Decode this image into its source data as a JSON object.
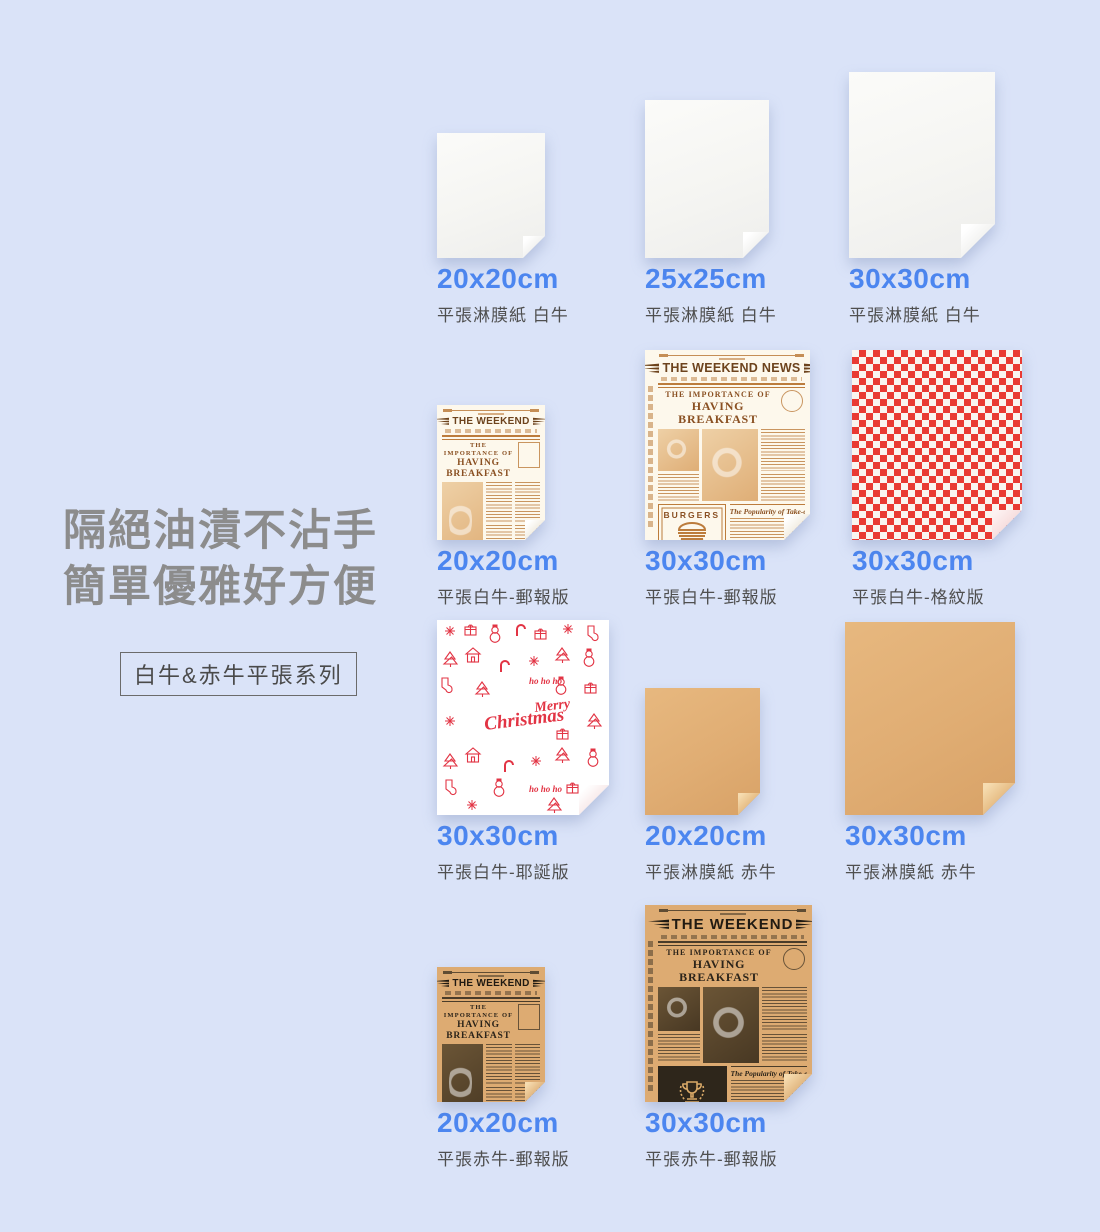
{
  "colors": {
    "background": "#dae3f8",
    "accent_blue": "#4c86f0",
    "text_gray": "#4f4f4f",
    "headline_gray": "#8c8c8c",
    "checker_red": "#e93a33",
    "kraft": "#e0ad73",
    "newsprint_ink": "#bc7c3c",
    "kraft_ink": "#2c241a",
    "xmas_red": "#e23444"
  },
  "hero": {
    "headline_line1": "隔絕油漬不沾手",
    "headline_line2": "簡單優雅好方便",
    "badge": "白牛&赤牛平張系列"
  },
  "newsprint": {
    "masthead": "THE WEEKEND",
    "masthead_news": "THE WEEKEND NEWS",
    "headline_top": "THE IMPORTANCE OF",
    "headline_main": "HAVING BREAKFAST",
    "burgers_label": "BURGERS",
    "homemade_label": "HOMEMADE",
    "takeout_headline": "The Popularity of Take-out Food in School"
  },
  "xmas": {
    "merry": "Merry",
    "christmas": "Christmas",
    "ho": "ho ho ho"
  },
  "products": [
    {
      "size": "20x20cm",
      "desc": "平張淋膜紙 白牛"
    },
    {
      "size": "25x25cm",
      "desc": "平張淋膜紙 白牛"
    },
    {
      "size": "30x30cm",
      "desc": "平張淋膜紙 白牛"
    },
    {
      "size": "20x20cm",
      "desc": "平張白牛-郵報版"
    },
    {
      "size": "30x30cm",
      "desc": "平張白牛-郵報版"
    },
    {
      "size": "30x30cm",
      "desc": "平張白牛-格紋版"
    },
    {
      "size": "30x30cm",
      "desc": "平張白牛-耶誕版"
    },
    {
      "size": "20x20cm",
      "desc": "平張淋膜紙 赤牛"
    },
    {
      "size": "30x30cm",
      "desc": "平張淋膜紙 赤牛"
    },
    {
      "size": "20x20cm",
      "desc": "平張赤牛-郵報版"
    },
    {
      "size": "30x30cm",
      "desc": "平張赤牛-郵報版"
    }
  ]
}
